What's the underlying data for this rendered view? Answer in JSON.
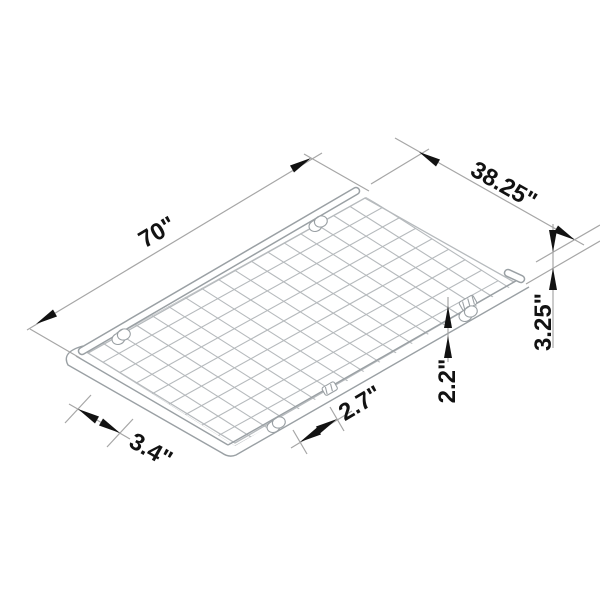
{
  "title": "Wire grid panel dimension diagram",
  "dimensions": {
    "length": "70\"",
    "width": "38.25\"",
    "total_height": "3.25\"",
    "frame_height": "2.2\"",
    "caster_inset_right": "2.7\"",
    "caster_inset_left": "3.4\""
  },
  "grid": {
    "cells_long": 17,
    "cells_short": 9
  },
  "colors": {
    "background": "#ffffff",
    "mesh_line": "#b6babd",
    "frame_line": "#9aa0a4",
    "dimension_line": "#a6a6a6",
    "annotation": "#121212"
  }
}
